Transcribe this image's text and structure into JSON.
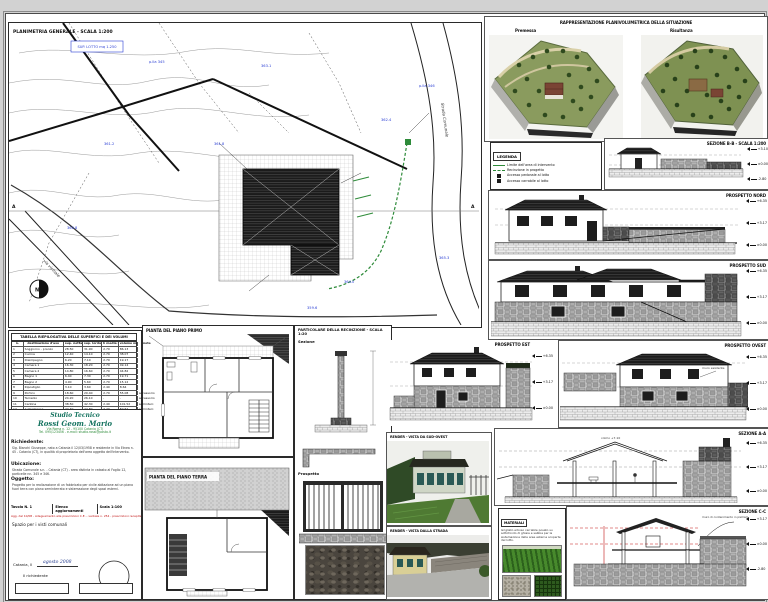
{
  "site_plan": {
    "title": "PLANIMETRIA GENERALE - SCALA 1:200",
    "sup_box": "SUP. LOTTO mq 1.250",
    "road_label": "Strada Comunale",
    "via_label": "via vicinale",
    "section_tag_left": "A",
    "section_tag_right": "A",
    "parcel_labels": [
      "p.lla 345",
      "361.2",
      "363.1",
      "p.lla 346",
      "360.8",
      "359.6",
      "365.3",
      "362.4",
      "361.8",
      "364.0"
    ]
  },
  "renders3d": {
    "title": "RAPPRESENTAZIONE PLANIVOLUMETRICA DELLA SITUAZIONE",
    "left_label": "Premessa",
    "right_label": "Risultanza"
  },
  "legend": {
    "title": "LEGENDA",
    "items": [
      {
        "type": "line-solid",
        "label": "Limite dell'area di intervento"
      },
      {
        "type": "line-dash",
        "label": "Recinzione in progetto"
      },
      {
        "type": "box",
        "label": "Accesso pedonale al lotto"
      },
      {
        "type": "box",
        "label": "Accesso carrabile al lotto"
      }
    ]
  },
  "panels": {
    "sezione_bb": {
      "title": "SEZIONE B-B - SCALA 1:200",
      "quotas": [
        "+3.10",
        "±0.00",
        "-2.80"
      ]
    },
    "prospetto_nord": {
      "title": "PROSPETTO NORD",
      "quotas": [
        "+6.35",
        "+3.17",
        "±0.00"
      ]
    },
    "prospetto_sud": {
      "title": "PROSPETTO SUD",
      "quotas": [
        "+6.35",
        "+3.17",
        "±0.00"
      ]
    },
    "prospetto_est": {
      "title": "PROSPETTO EST",
      "quotas": [
        "+6.35",
        "+3.17",
        "±0.00"
      ]
    },
    "prospetto_ovest": {
      "title": "PROSPETTO OVEST",
      "quotas": [
        "+6.35",
        "+3.17",
        "±0.00"
      ],
      "note": "muro esistente"
    },
    "sezione_aa": {
      "title": "SEZIONE A-A",
      "quotas": [
        "+6.35",
        "+3.17",
        "±0.00"
      ],
      "ridge_note": "colmo +7.10"
    },
    "sezione_cc": {
      "title": "SEZIONE C-C",
      "quotas": [
        "+3.17",
        "±0.00",
        "-2.80"
      ],
      "note": "muro di contenimento in pietrame"
    },
    "render_sud": {
      "title": "RENDER - VISTA DA SUD-OVEST"
    },
    "render_strada": {
      "title": "RENDER - VISTA DALLA STRADA"
    },
    "materiali": {
      "title": "MATERIALI",
      "text": "Grigliato erboso carrabile posato su sottofondo di ghiaia e sabbia per la sistemazione delle aree esterne scoperte del lotto."
    },
    "pianta_primo": {
      "title": "PIANTA DEL PIANO PRIMO"
    },
    "pianta_terra": {
      "title": "PIANTA DEL PIANO TERRA"
    },
    "recinzione": {
      "title": "PARTICOLARE DELLA RECINZIONE - SCALA 1:20",
      "sezione_label": "Sezione",
      "prospetto_label": "Prospetto"
    }
  },
  "area_table": {
    "title": "TABELLA RIEPILOGATIVA DELLE SUPERFICI E DEI VOLUMI",
    "headers": [
      "n.",
      "destinazione d'uso",
      "sup. netta mq",
      "sup. lorda mq",
      "h media m",
      "volume mc",
      "note"
    ],
    "rows": [
      [
        "1",
        "Soggiorno - pranzo",
        "28.50",
        "31.90",
        "2.70",
        "86.13",
        ""
      ],
      [
        "2",
        "Cucina",
        "12.40",
        "14.10",
        "2.70",
        "38.07",
        ""
      ],
      [
        "3",
        "Disimpegno",
        "6.20",
        "7.10",
        "2.70",
        "19.17",
        ""
      ],
      [
        "4",
        "Camera 1",
        "16.30",
        "18.20",
        "2.70",
        "49.14",
        ""
      ],
      [
        "5",
        "Camera 2",
        "14.80",
        "16.60",
        "2.70",
        "44.82",
        ""
      ],
      [
        "6",
        "Bagno 1",
        "6.40",
        "7.30",
        "2.70",
        "19.71",
        ""
      ],
      [
        "7",
        "Bagno 2",
        "4.90",
        "5.60",
        "2.70",
        "15.12",
        ""
      ],
      [
        "8",
        "Ripostiglio",
        "3.10",
        "3.60",
        "2.40",
        "8.64",
        ""
      ],
      [
        "9",
        "Portico",
        "18.60",
        "20.40",
        "2.70",
        "55.08",
        "accessorio"
      ],
      [
        "10",
        "Terrazzo",
        "24.20",
        "26.10",
        "-",
        "-",
        "accessorio"
      ],
      [
        "11",
        "Cantina",
        "38.50",
        "42.30",
        "2.40",
        "101.52",
        "seminterr."
      ],
      [
        "12",
        "Autorimessa",
        "22.40",
        "24.80",
        "2.40",
        "59.52",
        "seminterr."
      ],
      [
        "13",
        "Totale",
        "196.30",
        "218.00",
        "-",
        "496.92",
        ""
      ]
    ]
  },
  "title_block": {
    "studio_line1": "Studio Tecnico",
    "studio_line2": "Rossi Geom. Mario",
    "studio_line3": "Via Roma n. 12 - 95100 Catania (CT)",
    "studio_line4": "Tel. 095/123456 - e-mail: studio.rossi@posta.it",
    "richiedente_label": "Richiedente:",
    "richiedente_text": "Sig. Bianchi Giuseppe, nato a Catania il 12/03/1958 e residente in Via Etnea n. 45 - Catania (CT), in qualità di proprietario dell'area oggetto dell'intervento.",
    "ubicazione_label": "Ubicazione:",
    "ubicazione_text": "Strada Comunale s.n. - Catania (CT) - area distinta in catasto al Foglio 12, particelle nn. 345 e 346.",
    "oggetto_label": "Oggetto:",
    "oggetto_text": "Progetto per la realizzazione di un fabbricato per civile abitazione ad un piano fuori terra con piano seminterrato e sistemazione degli spazi esterni.",
    "tavola_label": "Tavola N. 1",
    "agg_label": "Elenco aggiornamenti",
    "scala_label": "Scala 1:100",
    "agg_red": "Agg. del 10/08 - Adeguamento alle prescrizioni C.E. - verbale n. 254 - prescrizioni recepite",
    "visti_label": "Spazio per i visti comunali",
    "luogo_label": "Catania, lì",
    "luogo_value": "agosto 2008",
    "firma_label": "Il richiedente"
  },
  "colors": {
    "accent_green": "#2e8b3a",
    "annotation_blue": "#2b3fd4",
    "revision_red": "#c11212"
  }
}
